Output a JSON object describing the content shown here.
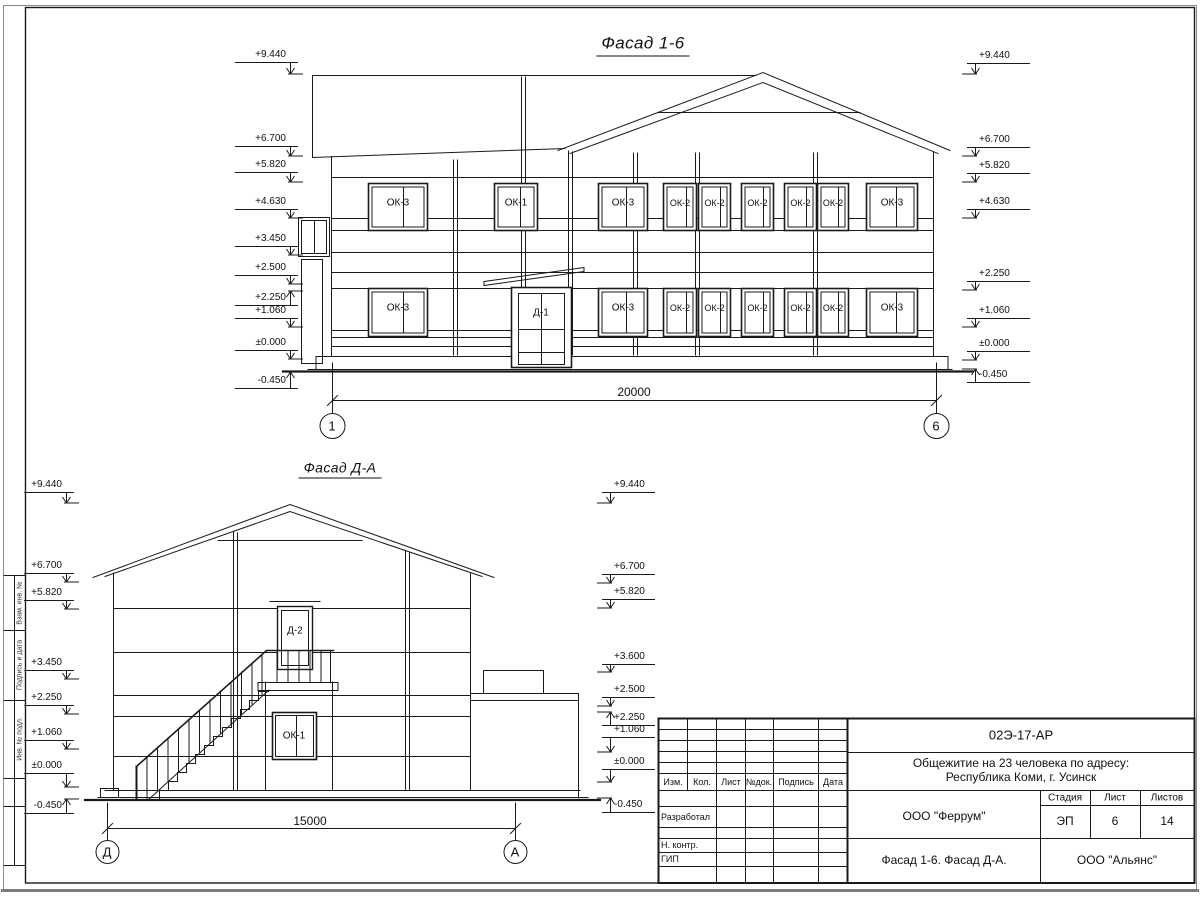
{
  "sheet": {
    "facade_16": {
      "title": "Фасад 1-6",
      "elevations_left": [
        "+9.440",
        "+6.700",
        "+5.820",
        "+4.630",
        "+3.450",
        "+2.500",
        "+2.250",
        "+1.060",
        "±0.000",
        "-0.450"
      ],
      "elevations_right": [
        "+9.440",
        "+6.700",
        "+5.820",
        "+4.630",
        "+2.250",
        "+1.060",
        "±0.000",
        "-0.450"
      ],
      "windows_upper": [
        "ОК-3",
        "ОК-1",
        "ОК-3",
        "ОК-2",
        "ОК-2",
        "ОК-2",
        "ОК-2",
        "ОК-2",
        "ОК-3"
      ],
      "windows_lower": [
        "ОК-3",
        "ОК-3",
        "ОК-2",
        "ОК-2",
        "ОК-2",
        "ОК-2",
        "ОК-2",
        "ОК-3"
      ],
      "door": "Д-1",
      "dimension": "20000",
      "axes": [
        "1",
        "6"
      ]
    },
    "facade_da": {
      "title": "Фасад Д-А",
      "elevations_left": [
        "+9.440",
        "+6.700",
        "+5.820",
        "+3.450",
        "+2.250",
        "+1.060",
        "±0.000",
        "-0.450"
      ],
      "elevations_right": [
        "+9.440",
        "+6.700",
        "+5.820",
        "+3.600",
        "+2.500",
        "+2.250",
        "+1.060",
        "±0.000",
        "-0.450"
      ],
      "door": "Д-2",
      "window": "ОК-1",
      "dimension": "15000",
      "axes": [
        "Д",
        "А"
      ]
    },
    "side_stamp": [
      "Взам. инв. №",
      "Подпись и дата",
      "Инв. № подл."
    ],
    "title_block": {
      "doc_number": "02Э-17-АР",
      "project_line1": "Общежитие на 23 человека по адресу:",
      "project_line2": "Республика Коми, г. Усинск",
      "columns": [
        "Изм.",
        "Кол.",
        "Лист",
        "№док.",
        "Подпись",
        "Дата"
      ],
      "row_labels": [
        "Разработал",
        "Н. контр.",
        "ГИП"
      ],
      "company": "ООО \"Феррум\"",
      "stage_label": "Стадия",
      "sheet_label": "Лист",
      "sheets_label": "Листов",
      "stage": "ЭП",
      "sheet_no": "6",
      "sheets_total": "14",
      "sheet_title": "Фасад 1-6. Фасад Д-А.",
      "contractor": "ООО \"Альянс\""
    }
  }
}
